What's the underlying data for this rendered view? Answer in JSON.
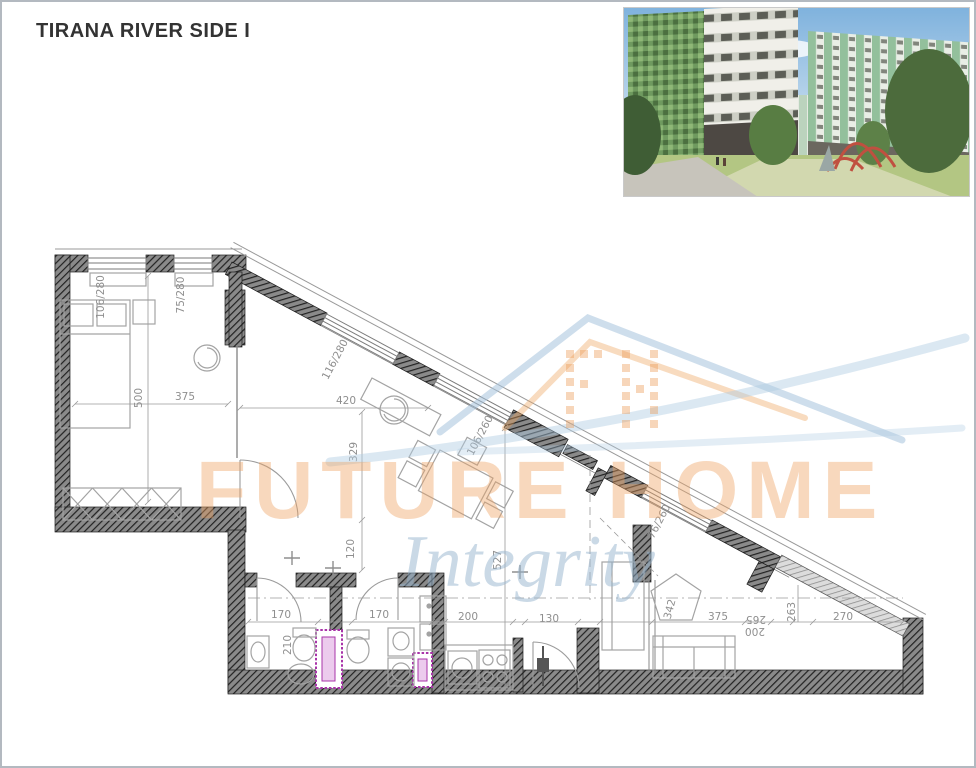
{
  "page": {
    "title": "TIRANA RIVER SIDE I"
  },
  "photo": {
    "label": "residential-complex-rendering"
  },
  "watermark": {
    "brand_top": "FUTURE HOME",
    "brand_script": "Integrity",
    "orange": "#eda26b",
    "blue": "#a9c3d9"
  },
  "plan": {
    "wall_dark": "#2a2a2a",
    "shaft_magenta": "#a934a9",
    "line_gray": "#8f8f8f",
    "dimensions": [
      {
        "text": "106/280",
        "x": 104,
        "y": 297,
        "rot": -90
      },
      {
        "text": "75/280",
        "x": 184,
        "y": 295,
        "rot": -90
      },
      {
        "text": "116/280",
        "x": 338,
        "y": 361,
        "rot": -62
      },
      {
        "text": "106/260",
        "x": 483,
        "y": 437,
        "rot": -62
      },
      {
        "text": "76/260",
        "x": 662,
        "y": 523,
        "rot": -62
      },
      {
        "text": "500",
        "x": 142,
        "y": 398,
        "rot": -90
      },
      {
        "text": "375",
        "x": 185,
        "y": 400,
        "rot": 0
      },
      {
        "text": "420",
        "x": 346,
        "y": 404,
        "rot": 0
      },
      {
        "text": "329",
        "x": 357,
        "y": 452,
        "rot": -90
      },
      {
        "text": "120",
        "x": 354,
        "y": 549,
        "rot": -90
      },
      {
        "text": "527",
        "x": 501,
        "y": 560,
        "rot": -90
      },
      {
        "text": "170",
        "x": 281,
        "y": 618,
        "rot": 0
      },
      {
        "text": "170",
        "x": 379,
        "y": 618,
        "rot": 0
      },
      {
        "text": "210",
        "x": 291,
        "y": 645,
        "rot": -90
      },
      {
        "text": "200",
        "x": 468,
        "y": 620,
        "rot": 0
      },
      {
        "text": "130",
        "x": 549,
        "y": 622,
        "rot": 0
      },
      {
        "text": "342",
        "x": 673,
        "y": 610,
        "rot": -75
      },
      {
        "text": "375",
        "x": 718,
        "y": 620,
        "rot": 0
      },
      {
        "text": "265",
        "x": 756,
        "y": 616,
        "rot": 180
      },
      {
        "text": "200",
        "x": 755,
        "y": 628,
        "rot": 180
      },
      {
        "text": "263",
        "x": 795,
        "y": 612,
        "rot": -90
      },
      {
        "text": "270",
        "x": 843,
        "y": 620,
        "rot": 0
      }
    ]
  }
}
